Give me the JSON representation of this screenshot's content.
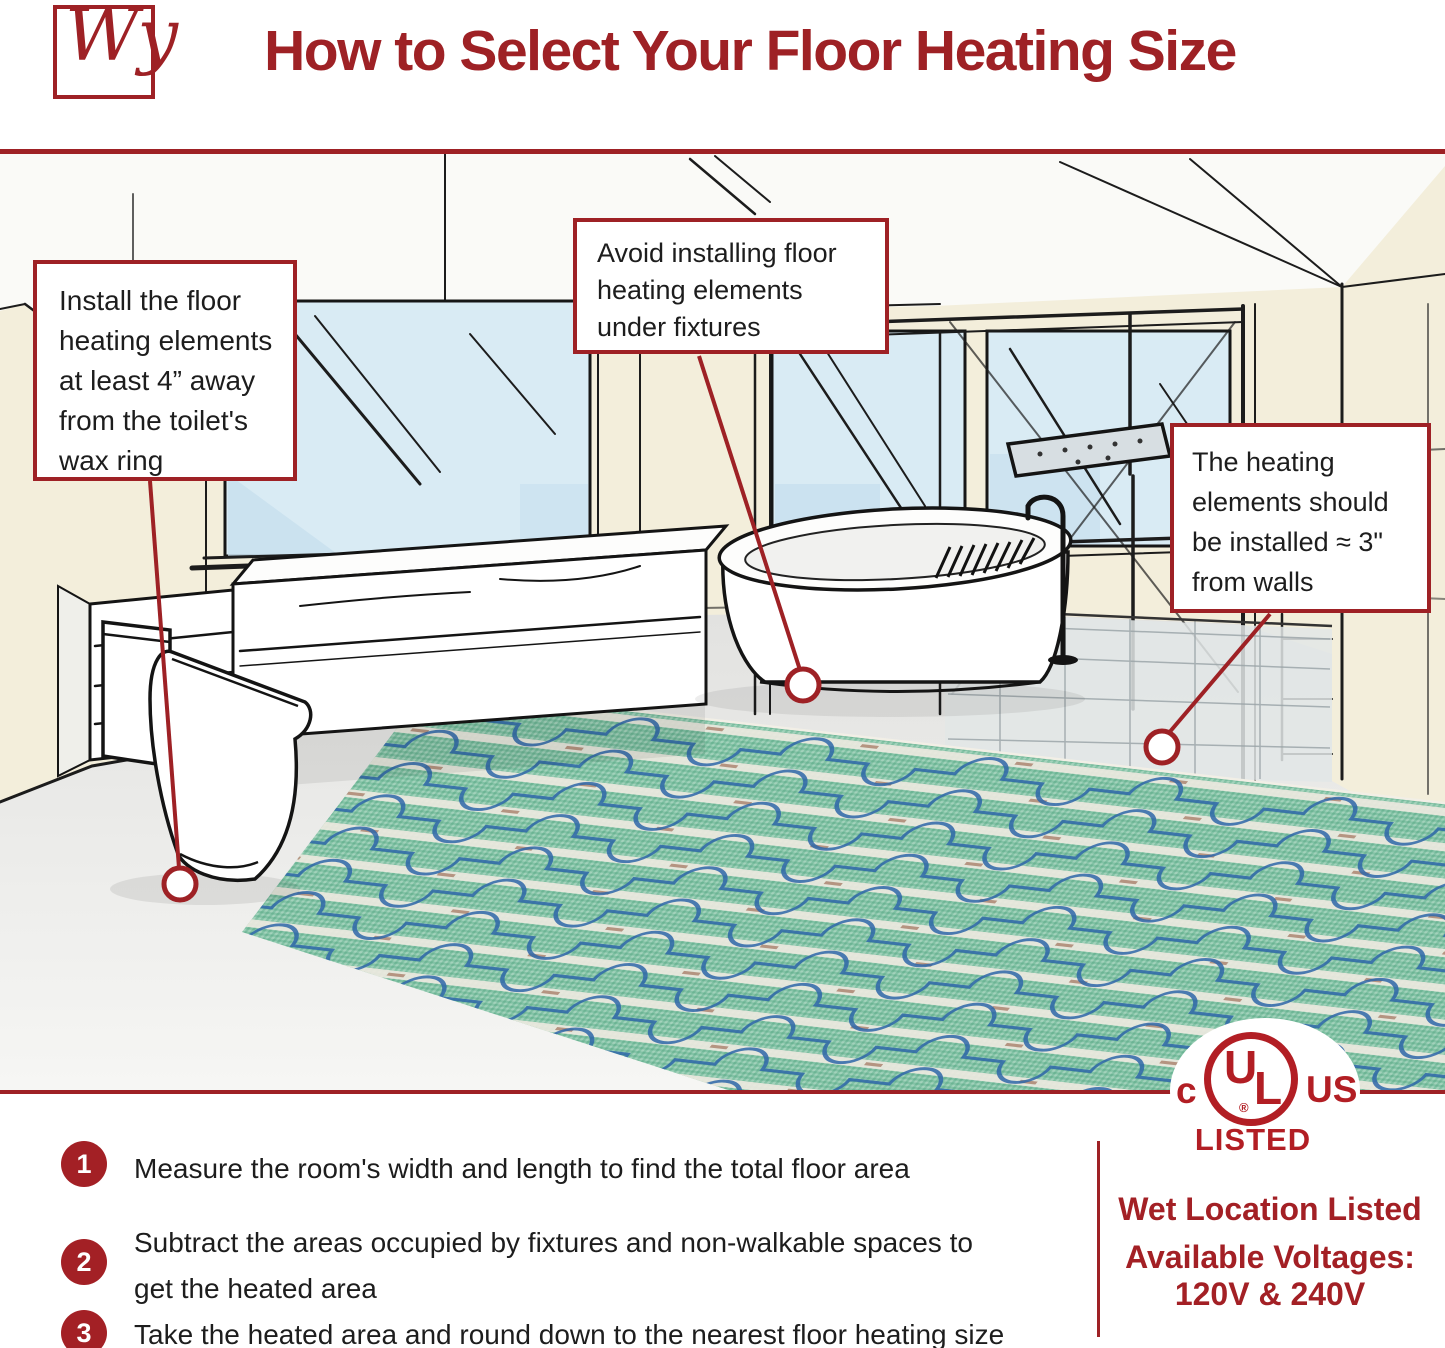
{
  "header": {
    "logo_text": "Wy",
    "title": "How to Select Your Floor Heating Size"
  },
  "callouts": {
    "toilet": {
      "lines": [
        "Install the floor",
        "heating elements",
        "at least 4” away",
        "from the toilet's",
        "wax ring"
      ]
    },
    "fixtures": {
      "lines": [
        "Avoid installing floor",
        "heating elements",
        "under fixtures"
      ]
    },
    "walls": {
      "lines": [
        "The heating",
        "elements should",
        "be installed ≈ 3\"",
        "from walls"
      ]
    }
  },
  "steps": [
    {
      "num": "1",
      "lines": [
        "Measure the room's width and length to find the total floor area"
      ]
    },
    {
      "num": "2",
      "lines": [
        "Subtract the areas occupied by fixtures and non-walkable spaces to",
        "get the heated area"
      ]
    },
    {
      "num": "3",
      "lines": [
        "Take the heated area and round down to the nearest floor heating size"
      ]
    }
  ],
  "certification": {
    "c": "c",
    "u": "U",
    "l": "L",
    "registered": "®",
    "us": "US",
    "listed": "LISTED"
  },
  "right_panel": {
    "wet_location": "Wet Location Listed",
    "voltages_label": "Available Voltages:",
    "voltages": "120V & 240V"
  },
  "colors": {
    "brand_red": "#9E2125",
    "ul_red": "#B21E24",
    "mat_green": "#82C2A5",
    "cable_blue": "#2E66A8",
    "glass_blue": "#D9EBF4",
    "wall_cream": "#F3EEDB"
  }
}
